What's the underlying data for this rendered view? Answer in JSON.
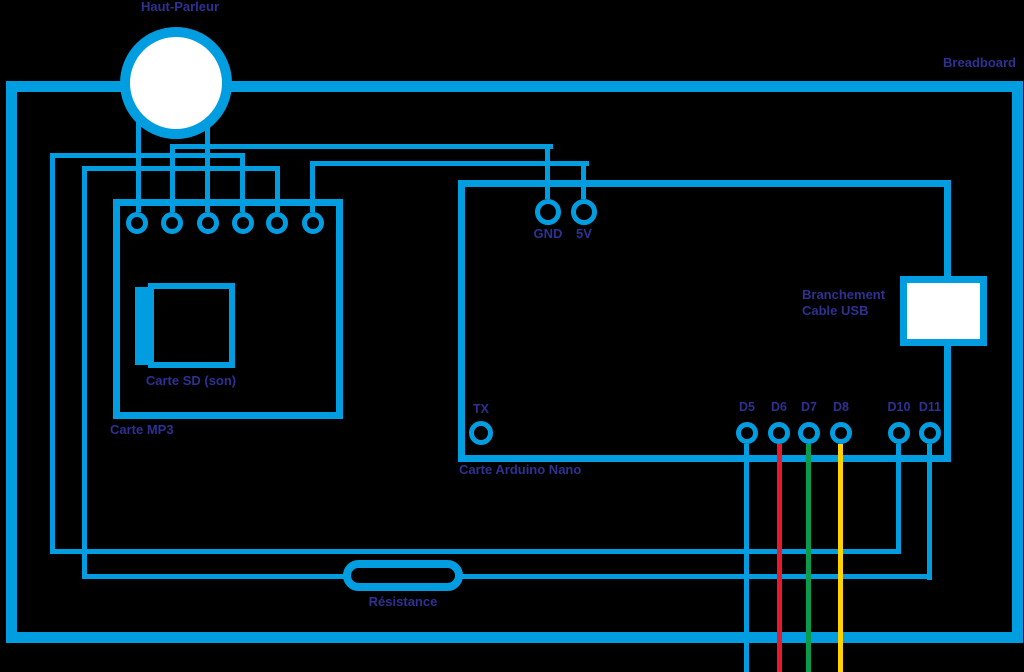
{
  "colors": {
    "bg": "#000000",
    "wire_blue": "#009EE0",
    "wire_red": "#E8192C",
    "wire_green": "#089B4B",
    "wire_yellow": "#FFD200",
    "label_color": "#2E3192",
    "fill_white": "#FFFFFF"
  },
  "labels": {
    "breadboard": "Breadboard",
    "speaker": "Haut-Parleur",
    "mp3": "Carte MP3",
    "sd": "Carte SD (son)",
    "arduino": "Carte Arduino Nano",
    "resistor": "Résistance",
    "tx": "TX",
    "gnd": "GND",
    "five_v": "5V",
    "usb": [
      "Branchement",
      "Cable USB"
    ],
    "d_pins": [
      "D5",
      "D6",
      "D7",
      "D8",
      "D10",
      "D11"
    ]
  },
  "diagram": {
    "type": "wiring-schematic",
    "components": [
      "Haut-Parleur",
      "Carte MP3",
      "Carte SD (son)",
      "Carte Arduino Nano",
      "Branchement Cable USB",
      "Résistance",
      "Breadboard"
    ],
    "arduino_pins_shown": [
      "TX",
      "GND",
      "5V",
      "D5",
      "D6",
      "D7",
      "D8",
      "D10",
      "D11"
    ],
    "colored_wires": {
      "D5": "blue",
      "D6": "red",
      "D7": "green",
      "D8": "yellow"
    }
  }
}
